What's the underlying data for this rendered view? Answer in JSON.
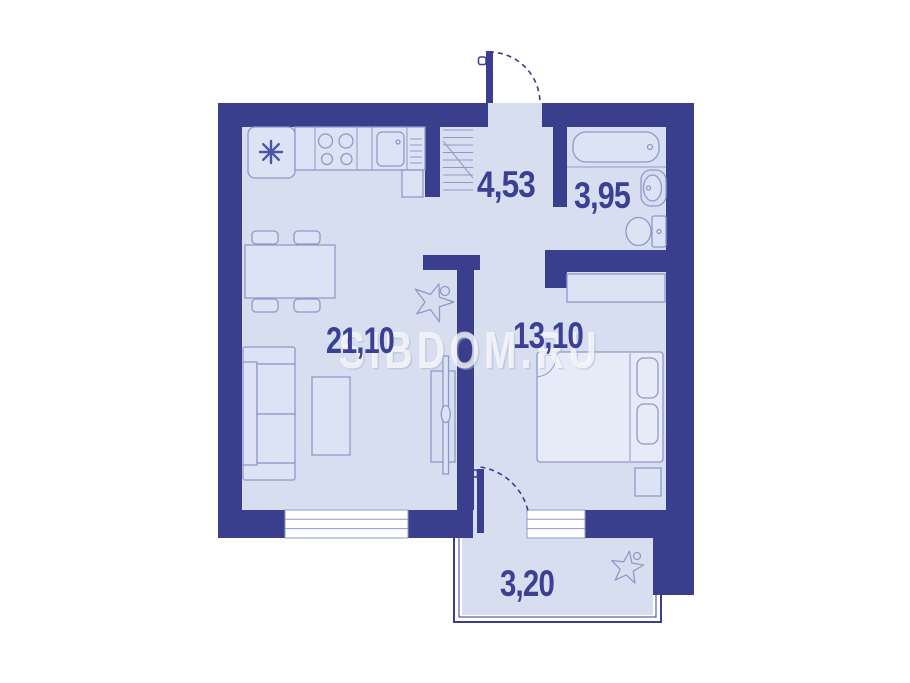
{
  "watermark": "SIBDOM.RU",
  "rooms": {
    "hallway_area": "4,53",
    "bathroom_area": "3,95",
    "living_kitchen_area": "21,10",
    "bedroom_area": "13,10",
    "balcony_area": "3,20"
  },
  "colors": {
    "wall": "#3b3e8c",
    "floor": "#d7def0",
    "furniture_outline": "#8f99c9",
    "room_label": "#3b4094",
    "background": "#ffffff"
  }
}
